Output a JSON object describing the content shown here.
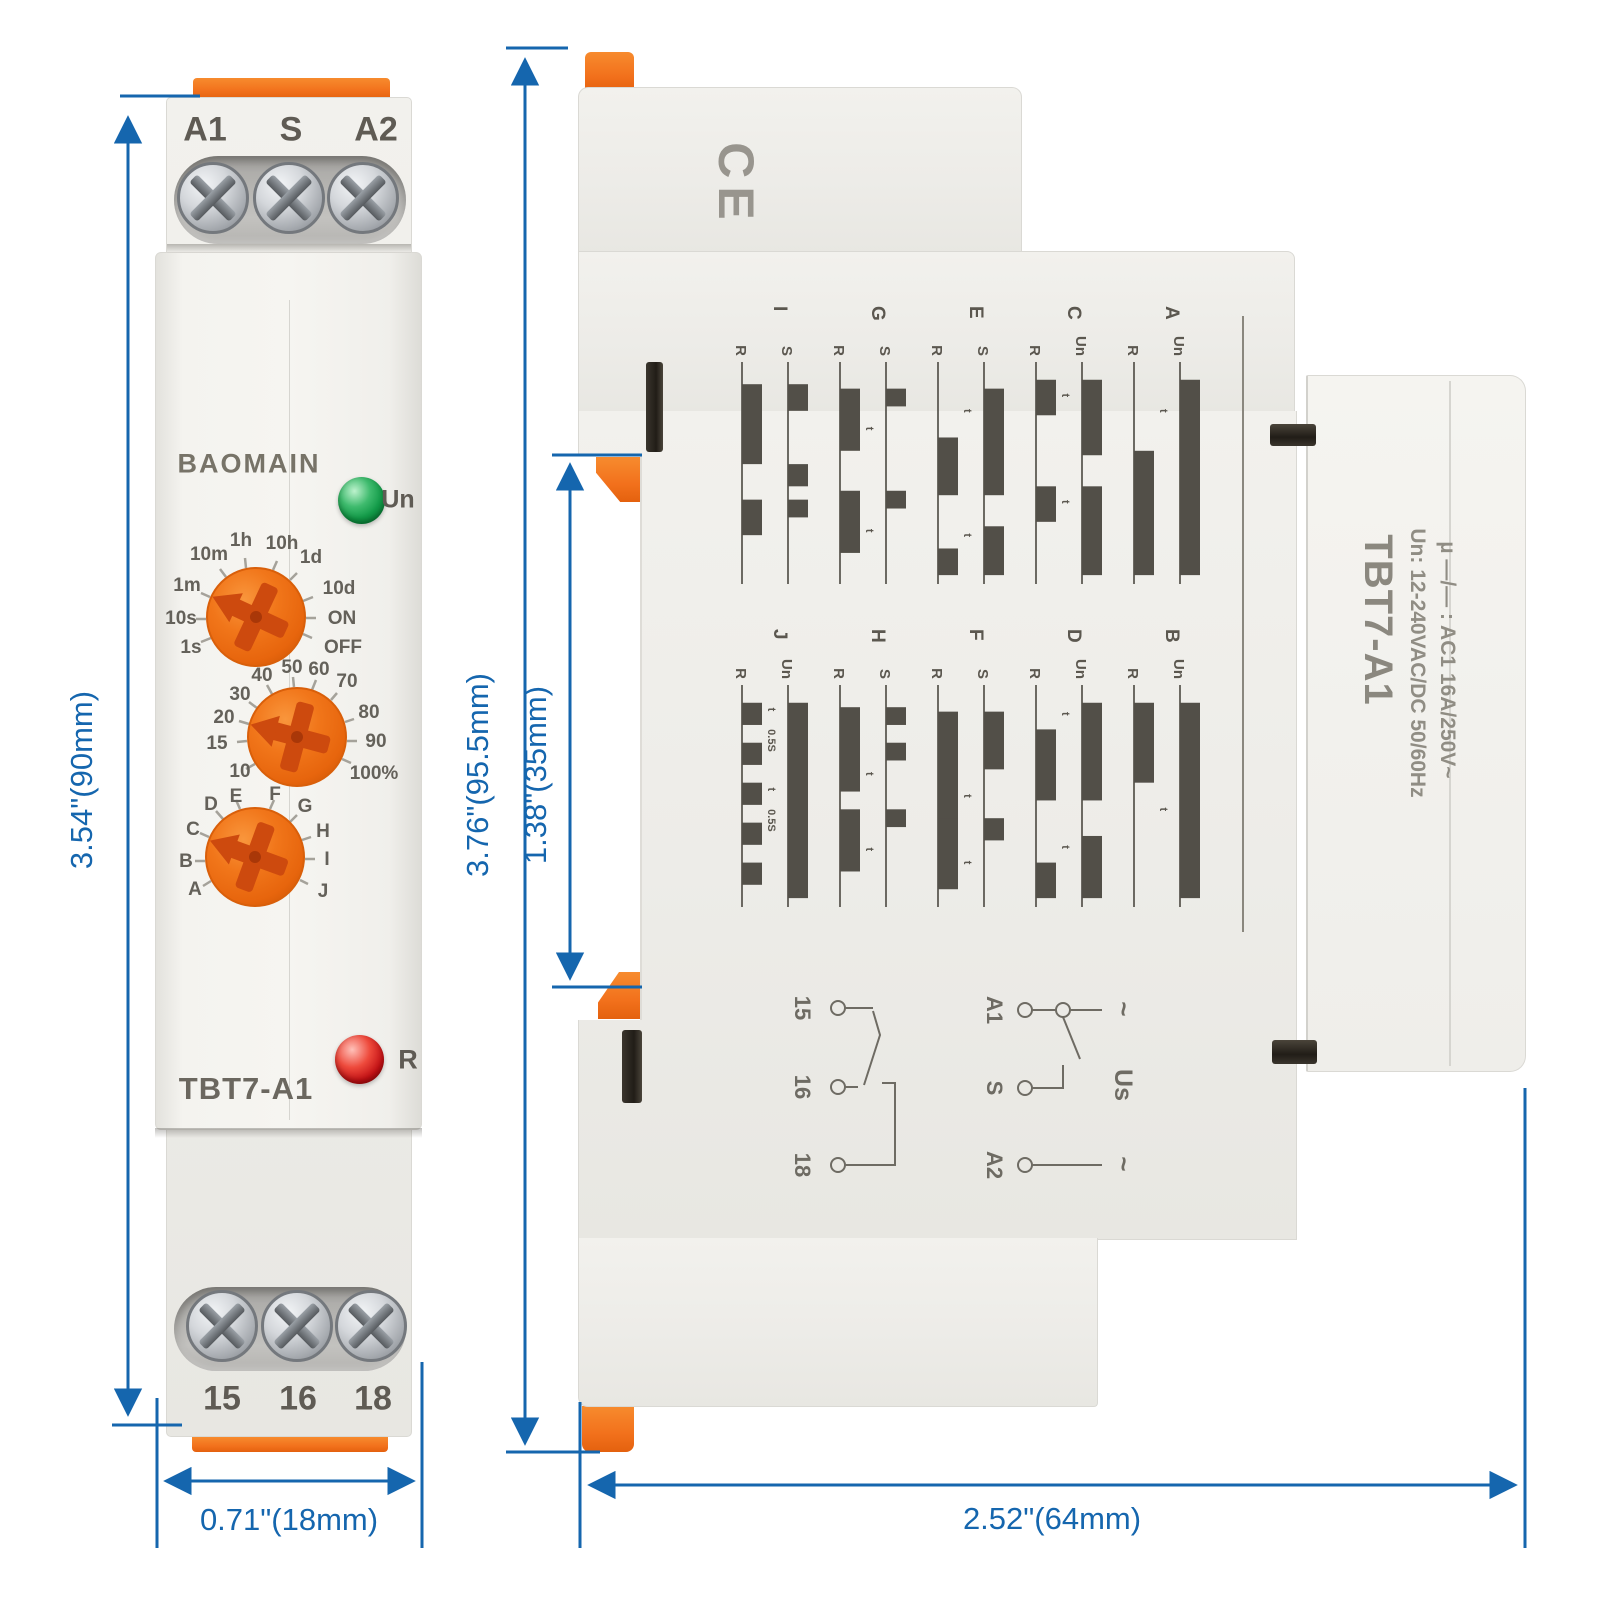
{
  "front_view": {
    "brand": "BAOMAIN",
    "model": "TBT7-A1",
    "top_terminals": [
      "A1",
      "S",
      "A2"
    ],
    "bottom_terminals": [
      "15",
      "16",
      "18"
    ],
    "power_led_label": "Un",
    "relay_led_label": "R",
    "time_dial_labels": [
      "10m",
      "1h",
      "10h",
      "1d",
      "10d",
      "ON",
      "OFF",
      "1m",
      "10s",
      "1s"
    ],
    "percent_dial_labels": [
      "10",
      "15",
      "20",
      "30",
      "40",
      "50",
      "60",
      "70",
      "80",
      "90",
      "100%"
    ],
    "function_dial_labels": [
      "A",
      "B",
      "C",
      "D",
      "E",
      "F",
      "G",
      "H",
      "I",
      "J"
    ],
    "dim_height": "3.54\"(90mm)",
    "dim_width": "0.71\"(18mm)"
  },
  "side_view": {
    "ce_mark": "CE",
    "model": "TBT7-A1",
    "rating_line1": "Un: 12-240VAC/DC 50/60Hz",
    "rating_line2": "µ —/— : AC1 16A/250V~",
    "timing_cells": [
      {
        "fn": "I",
        "top": "S",
        "bottom": "R",
        "top_seg": [
          [
            10,
            22
          ],
          [
            46,
            56
          ],
          [
            62,
            70
          ]
        ],
        "bot_seg": [
          [
            10,
            46
          ],
          [
            62,
            78
          ]
        ],
        "t_marks": []
      },
      {
        "fn": "G",
        "top": "S",
        "bottom": "R",
        "top_seg": [
          [
            12,
            20
          ],
          [
            58,
            66
          ]
        ],
        "bot_seg": [
          [
            12,
            40
          ],
          [
            58,
            86
          ]
        ],
        "t_marks": [
          {
            "x": 30,
            "s": "t"
          },
          {
            "x": 76,
            "s": "t"
          }
        ]
      },
      {
        "fn": "E",
        "top": "S",
        "bottom": "R",
        "top_seg": [
          [
            12,
            60
          ],
          [
            74,
            96
          ]
        ],
        "bot_seg": [
          [
            34,
            60
          ],
          [
            84,
            96
          ]
        ],
        "t_marks": [
          {
            "x": 22,
            "s": "t"
          },
          {
            "x": 78,
            "s": "t"
          }
        ]
      },
      {
        "fn": "C",
        "top": "Un",
        "bottom": "R",
        "top_seg": [
          [
            8,
            42
          ],
          [
            56,
            96
          ]
        ],
        "bot_seg": [
          [
            8,
            24
          ],
          [
            56,
            72
          ]
        ],
        "t_marks": [
          {
            "x": 15,
            "s": "t"
          },
          {
            "x": 63,
            "s": "t"
          }
        ]
      },
      {
        "fn": "A",
        "top": "Un",
        "bottom": "R",
        "top_seg": [
          [
            8,
            96
          ]
        ],
        "bot_seg": [
          [
            40,
            96
          ]
        ],
        "t_marks": [
          {
            "x": 22,
            "s": "t"
          }
        ]
      },
      {
        "fn": "J",
        "top": "Un",
        "bottom": "R",
        "top_seg": [
          [
            8,
            96
          ]
        ],
        "bot_seg": [
          [
            8,
            18
          ],
          [
            26,
            36
          ],
          [
            44,
            54
          ],
          [
            62,
            72
          ],
          [
            80,
            90
          ]
        ],
        "t_marks": [
          {
            "x": 11,
            "s": "t"
          },
          {
            "x": 25,
            "s": "0.5S"
          },
          {
            "x": 47,
            "s": "t"
          },
          {
            "x": 61,
            "s": "0.5S"
          }
        ]
      },
      {
        "fn": "H",
        "top": "S",
        "bottom": "R",
        "top_seg": [
          [
            10,
            18
          ],
          [
            26,
            34
          ],
          [
            56,
            64
          ]
        ],
        "bot_seg": [
          [
            10,
            48
          ],
          [
            56,
            84
          ]
        ],
        "t_marks": [
          {
            "x": 40,
            "s": "t"
          },
          {
            "x": 74,
            "s": "t"
          }
        ]
      },
      {
        "fn": "F",
        "top": "S",
        "bottom": "R",
        "top_seg": [
          [
            12,
            38
          ],
          [
            60,
            70
          ]
        ],
        "bot_seg": [
          [
            12,
            62
          ],
          [
            60,
            92
          ]
        ],
        "t_marks": [
          {
            "x": 50,
            "s": "t"
          },
          {
            "x": 80,
            "s": "t"
          }
        ]
      },
      {
        "fn": "D",
        "top": "Un",
        "bottom": "R",
        "top_seg": [
          [
            8,
            52
          ],
          [
            68,
            96
          ]
        ],
        "bot_seg": [
          [
            20,
            52
          ],
          [
            80,
            96
          ]
        ],
        "t_marks": [
          {
            "x": 13,
            "s": "t"
          },
          {
            "x": 73,
            "s": "t"
          }
        ]
      },
      {
        "fn": "B",
        "top": "Un",
        "bottom": "R",
        "top_seg": [
          [
            8,
            96
          ]
        ],
        "bot_seg": [
          [
            8,
            44
          ]
        ],
        "t_marks": [
          {
            "x": 56,
            "s": "t"
          }
        ]
      }
    ],
    "wiring": {
      "output_terminals": [
        "15",
        "16",
        "18"
      ],
      "supply_terminals": [
        "A1",
        "S",
        "A2"
      ],
      "supply_label": "Us",
      "ac_top": "~",
      "ac_bottom": "~"
    },
    "dim_height_total": "3.76\"(95.5mm)",
    "dim_rail": "1.38\"(35mm)",
    "dim_depth": "2.52\"(64mm)"
  },
  "colors": {
    "dimension_blue": "#1566ae",
    "device_orange": "#f2711c",
    "led_green": "#129a48",
    "led_red": "#c31115",
    "print_gray": "#8b887f"
  }
}
